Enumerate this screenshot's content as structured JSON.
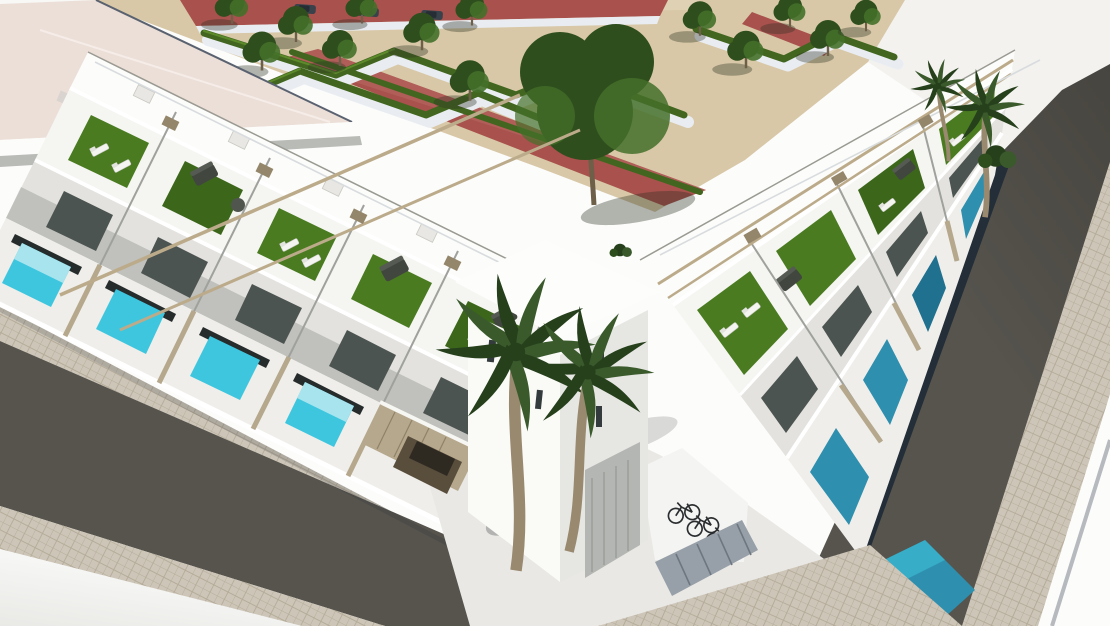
{
  "meta": {
    "title": "Aerial 3D architectural render: white Mediterranean townhouse complex with rooftop solariums, private pools, palm trees, landscaped park and asphalt roads"
  },
  "palette": {
    "bg": "#fcfcfb",
    "bgShade": "#e9e9e6",
    "groundWhite": "#f3f2ef",
    "sand": "#d8c8a7",
    "sandLight": "#e4d7ba",
    "redPath": "#a8514d",
    "redPathLight": "#b96a63",
    "walk": "#e9edf2",
    "hedge": "#42661f",
    "hedgeLight": "#5d8a2b",
    "tree": "#2f4e1d",
    "treeLight": "#44702a",
    "trunk": "#6e5f49",
    "shadow": "rgba(45,50,35,0.36)",
    "roofPink": "#ecdfd8",
    "white1": "#fcfcfa",
    "white2": "#f5f5f2",
    "white3": "#efeeea",
    "facade": "#e3e2de",
    "wallShade": "#d8d9d5",
    "wallDark": "#b9bbb7",
    "wallDarker": "#9fa19d",
    "glass": "#4b5451",
    "glassDark": "#262c2b",
    "grass": "#4a7b21",
    "grassDark": "#3c671b",
    "beam": "#bcab8a",
    "beamDark": "#94866a",
    "fence": "#b6a88c",
    "fenceShade": "#8f8269",
    "poolBright": "#3ec6df",
    "poolLight": "#a7e4ee",
    "poolTeal": "#2f8fae",
    "poolDeep": "#20708f",
    "asphalt": "#56544d",
    "asphaltDark": "#47453f",
    "pave": "#cdc6b8",
    "paveLine": "#b5ab99",
    "curb": "#b6b9bd",
    "navy": "#232e39",
    "carBlue": "#274b8f",
    "carBlueDark": "#1c3566",
    "carRoof": "#e3e9ec",
    "carBrown": "#594d3c",
    "carStreet": "#39414a",
    "slate": "#97a0a8",
    "slateDark": "#6e7780",
    "bike": "#2b2e30",
    "palm": "#3a5a2c",
    "palmDark": "#26401c",
    "palmTrunk": "#99896f",
    "railing": "#d8dcde"
  },
  "scene": {
    "park": {
      "label": "landscaped park with zigzag hedges",
      "trees": 14,
      "hedge_zigzags": 4,
      "walkways": "white paths",
      "street": "red clay street",
      "street_parked_cars": 3
    },
    "left_wing": {
      "label": "row of 5 white townhouses",
      "units": 5,
      "front_pools": 4,
      "features": [
        "rooftop solarium",
        "artificial turf",
        "pergola beams",
        "sun loungers",
        "tan slat fences"
      ]
    },
    "right_wing": {
      "label": "row of 4 white townhouses along right road",
      "units": 4,
      "front_pools": 5
    },
    "corner_tower": {
      "label": "corner building",
      "window_slits": 4,
      "garage_doors": 1
    },
    "amenities": {
      "bicycles": 3,
      "storage_shed": 1,
      "carport": 1,
      "parking_corner_marks": 4
    },
    "vehicles": {
      "blue_car": 1,
      "carport_car": 1
    },
    "vegetation": {
      "palm_trees": 4,
      "shrub_clusters": 2
    },
    "roads": {
      "left": "asphalt road with tiled sidewalks both sides",
      "right": "steep asphalt road with tiled sidewalk and curb line"
    }
  }
}
